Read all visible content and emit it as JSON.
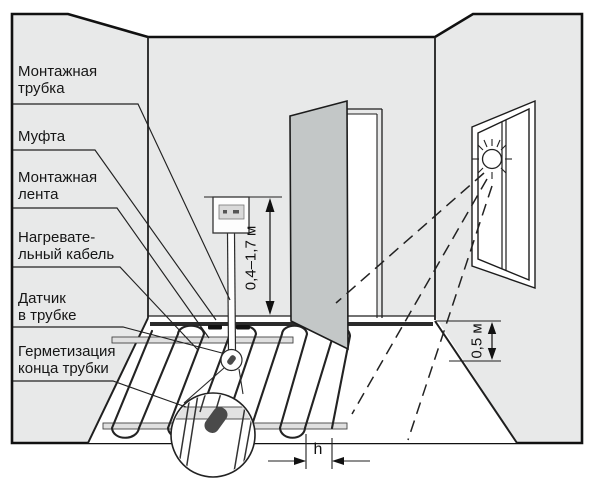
{
  "callouts": [
    {
      "id": "mounting-tube",
      "text": "Монтажная\nтрубка"
    },
    {
      "id": "coupling",
      "text": "Муфта"
    },
    {
      "id": "mounting-tape",
      "text": "Монтажная\nлента"
    },
    {
      "id": "heating-cable",
      "text": "Нагревате-\nльный кабель"
    },
    {
      "id": "sensor-in-tube",
      "text": "Датчик\nв трубке"
    },
    {
      "id": "tube-end-sealing",
      "text": "Герметизация\nконца трубки"
    }
  ],
  "dimensions": {
    "thermostat_height": "0,4–1,7 м",
    "window_wall_offset": "0,5 м",
    "cable_spacing": "h"
  },
  "colors": {
    "wall": "#e8e9e9",
    "floor": "#ffffff",
    "door": "#c3c7c7",
    "line": "#1f1f1f",
    "sealing_cap": "#4a4a4a",
    "mounting_tape": "#e0e0e0"
  }
}
